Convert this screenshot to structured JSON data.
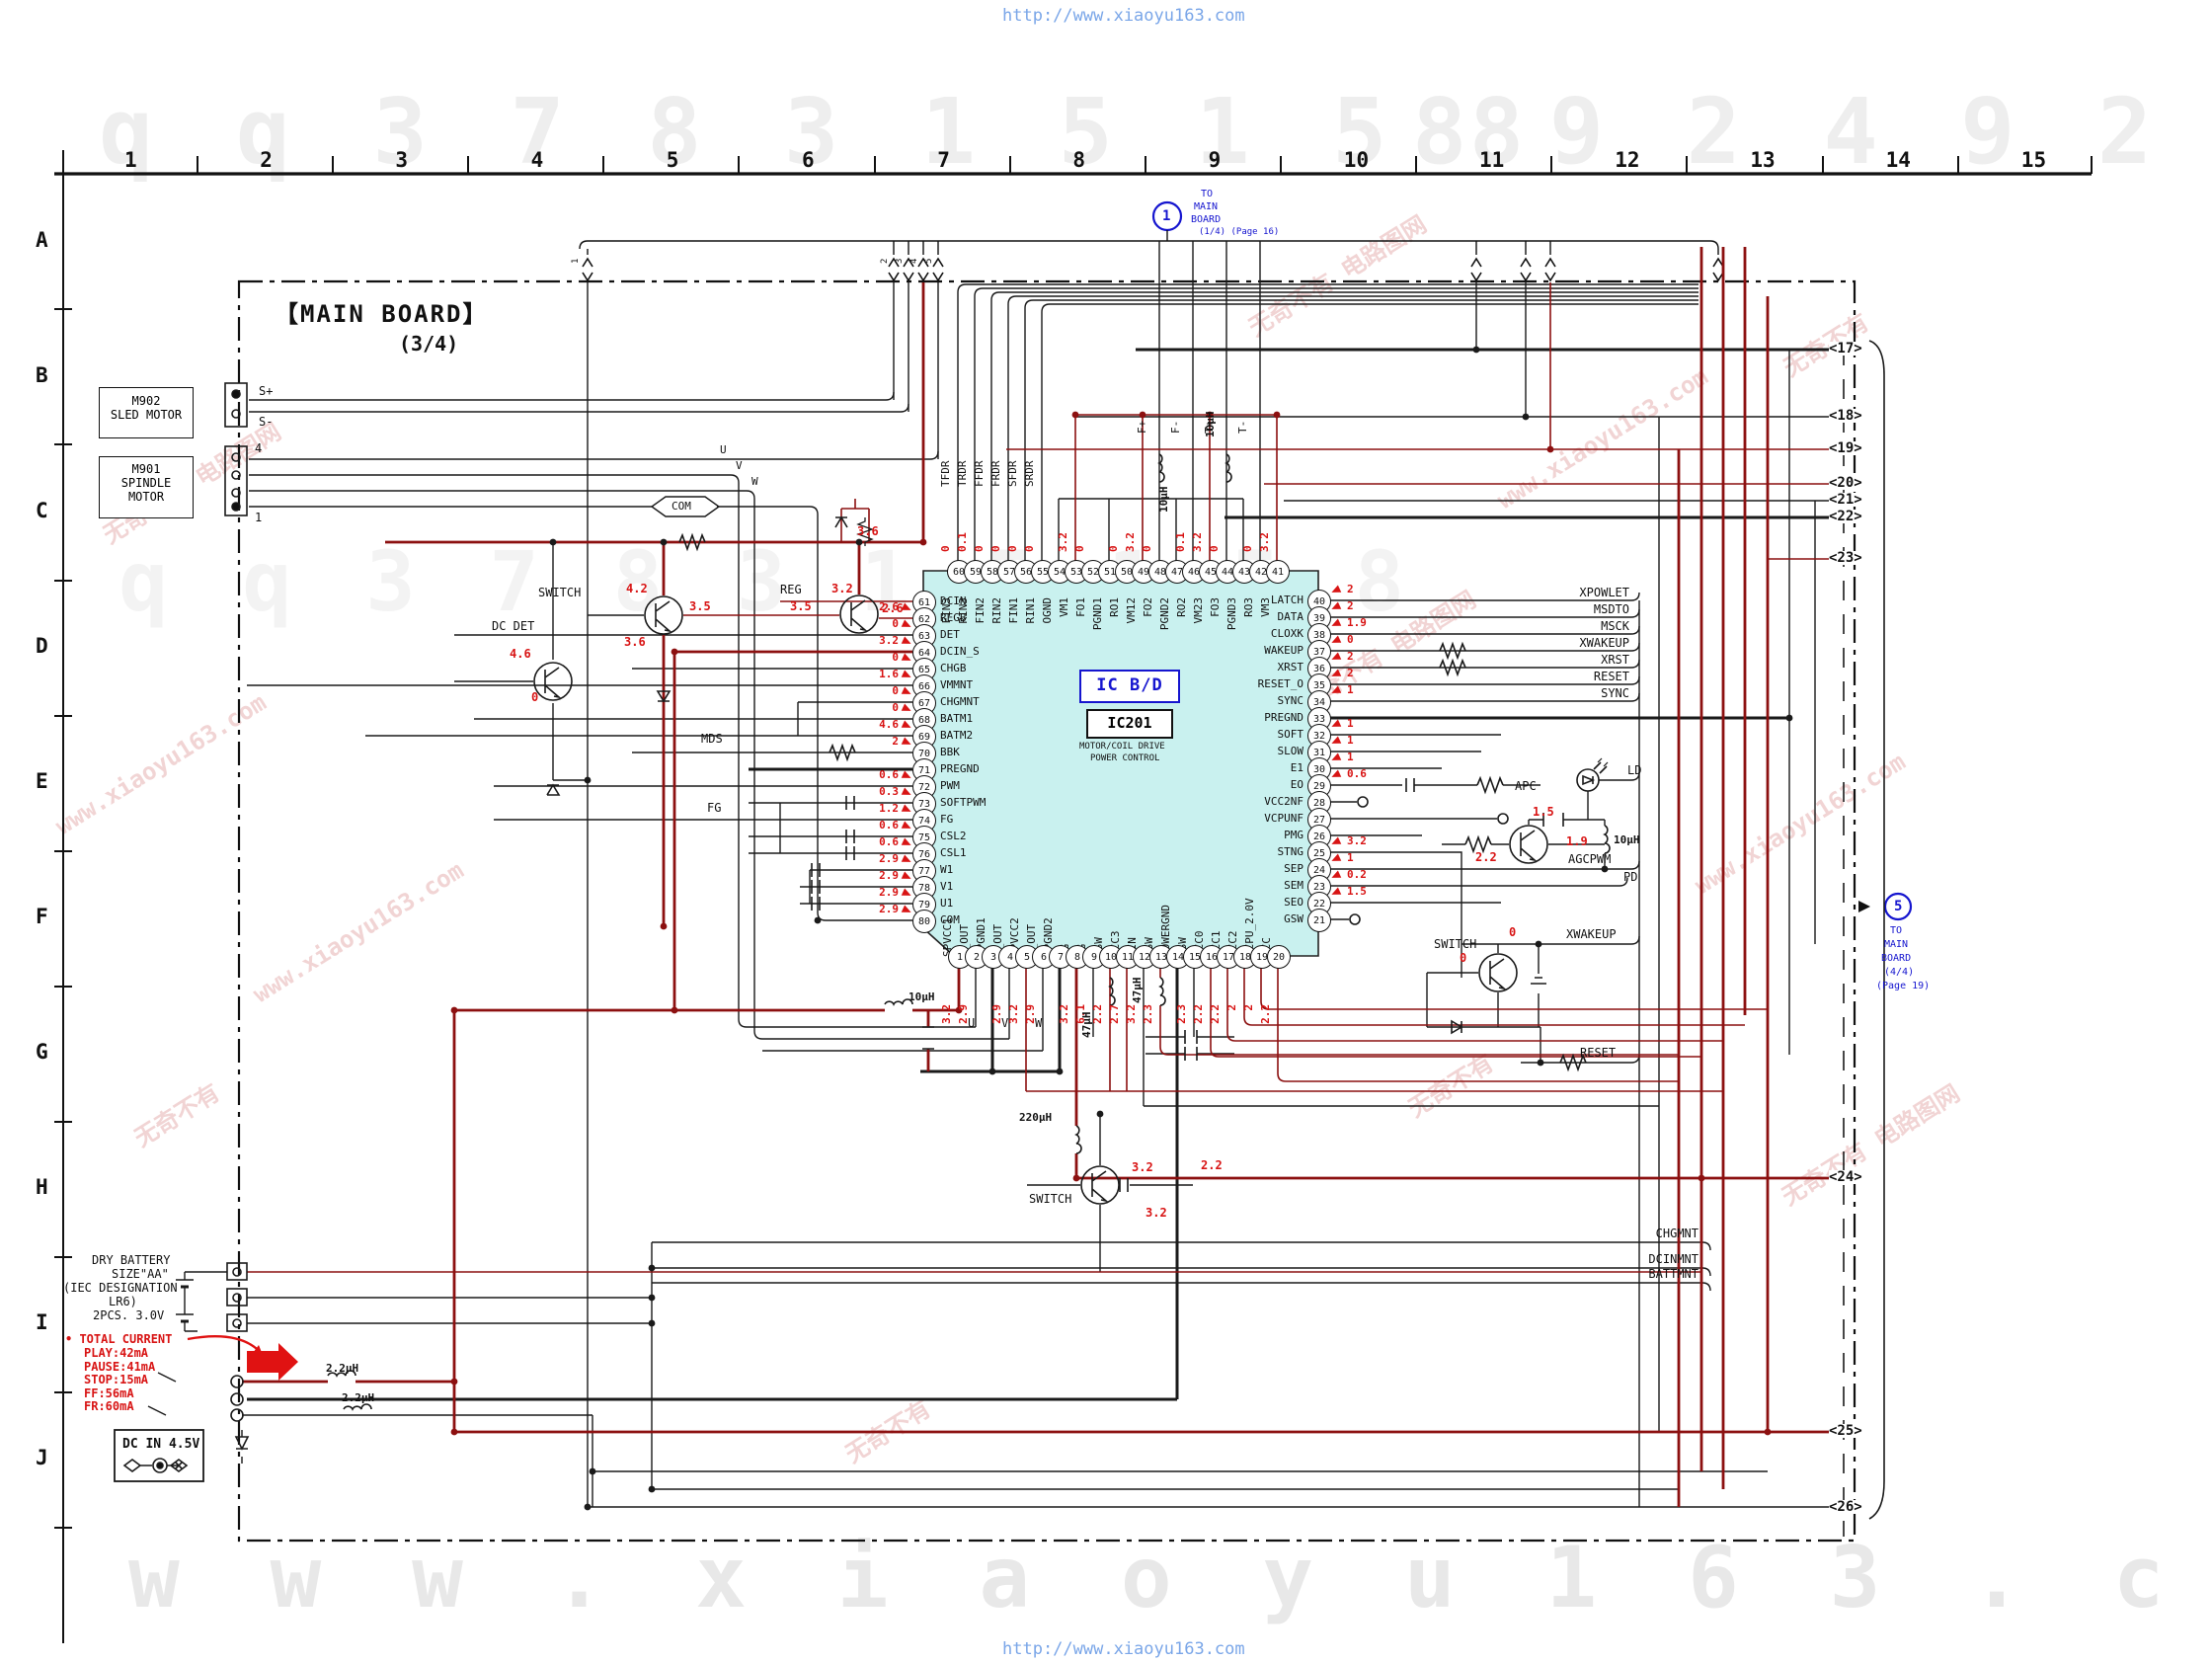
{
  "watermark": {
    "site_top": "http://www.xiaoyu163.com",
    "site_bottom": "http://www.xiaoyu163.com",
    "tiles": [
      "无奇不有  电路图网",
      "www.xiaoyu163.com",
      "无奇不有"
    ],
    "digits_left": "q q 3 7 8 3 1 5 1 5 8",
    "digits_right": "8 9 2 4 9 2 9 9",
    "big_bottom": "w w w . x i a o y u 1 6 3 . c o m"
  },
  "grid": {
    "columns": [
      "1",
      "2",
      "3",
      "4",
      "5",
      "6",
      "7",
      "8",
      "9",
      "10",
      "11",
      "12",
      "13",
      "14",
      "15"
    ],
    "rows": [
      "A",
      "B",
      "C",
      "D",
      "E",
      "F",
      "G",
      "H",
      "I",
      "J"
    ]
  },
  "board": {
    "title": "【MAIN BOARD】",
    "subtitle": "(3/4)"
  },
  "ref1": {
    "num": "1",
    "l1": "TO",
    "l2": "MAIN",
    "l3": "BOARD",
    "l4": "(1/4) (Page 16)"
  },
  "ref5": {
    "num": "5",
    "l1": "TO",
    "l2": "MAIN",
    "l3": "BOARD",
    "l4": "(4/4)",
    "l5": "(Page 19)"
  },
  "top_taps": [
    "1",
    "2",
    "3",
    "4",
    "5"
  ],
  "motors": {
    "sled": {
      "ref": "M902",
      "name": "SLED MOTOR",
      "pin_a": "S+",
      "pin_b": "S-"
    },
    "spindle": {
      "ref": "M901",
      "name1": "SPINDLE",
      "name2": "MOTOR",
      "pin_top": "4",
      "pin_bottom": "1"
    }
  },
  "ic": {
    "type_label": "IC B/D",
    "ref": "IC201",
    "desc1": "MOTOR/COIL DRIVE",
    "desc2": "POWER CONTROL",
    "left_pins": [
      {
        "n": "61",
        "name": "DCIN",
        "v": ""
      },
      {
        "n": "62",
        "name": "REGB",
        "v": "2.6"
      },
      {
        "n": "63",
        "name": "DET",
        "v": "0"
      },
      {
        "n": "64",
        "name": "DCIN_S",
        "v": "3.2"
      },
      {
        "n": "65",
        "name": "CHGB",
        "v": "0"
      },
      {
        "n": "66",
        "name": "VMMNT",
        "v": "1.6"
      },
      {
        "n": "67",
        "name": "CHGMNT",
        "v": "0"
      },
      {
        "n": "68",
        "name": "BATM1",
        "v": "0"
      },
      {
        "n": "69",
        "name": "BATM2",
        "v": "4.6"
      },
      {
        "n": "70",
        "name": "BBK",
        "v": "2"
      },
      {
        "n": "71",
        "name": "PREGND",
        "v": ""
      },
      {
        "n": "72",
        "name": "PWM",
        "v": "0.6"
      },
      {
        "n": "73",
        "name": "SOFTPWM",
        "v": "0.3"
      },
      {
        "n": "74",
        "name": "FG",
        "v": "1.2"
      },
      {
        "n": "75",
        "name": "CSL2",
        "v": "0.6"
      },
      {
        "n": "76",
        "name": "CSL1",
        "v": "0.6"
      },
      {
        "n": "77",
        "name": "W1",
        "v": "2.9"
      },
      {
        "n": "78",
        "name": "V1",
        "v": "2.9"
      },
      {
        "n": "79",
        "name": "U1",
        "v": "2.9"
      },
      {
        "n": "80",
        "name": "COM",
        "v": "2.9"
      }
    ],
    "top_pins": [
      {
        "n": "60",
        "name": "FIN3",
        "v": "0"
      },
      {
        "n": "59",
        "name": "RIN3",
        "v": "0.1"
      },
      {
        "n": "58",
        "name": "FIN2",
        "v": "0"
      },
      {
        "n": "57",
        "name": "RIN2",
        "v": "0"
      },
      {
        "n": "56",
        "name": "FIN1",
        "v": "0"
      },
      {
        "n": "55",
        "name": "RIN1",
        "v": "0"
      },
      {
        "n": "54",
        "name": "OGND",
        "v": ""
      },
      {
        "n": "53",
        "name": "VM1",
        "v": "3.2"
      },
      {
        "n": "52",
        "name": "FO1",
        "v": "0"
      },
      {
        "n": "51",
        "name": "PGND1",
        "v": ""
      },
      {
        "n": "50",
        "name": "RO1",
        "v": "0"
      },
      {
        "n": "49",
        "name": "VM12",
        "v": "3.2"
      },
      {
        "n": "48",
        "name": "FO2",
        "v": "0"
      },
      {
        "n": "47",
        "name": "PGND2",
        "v": ""
      },
      {
        "n": "46",
        "name": "RO2",
        "v": "0.1"
      },
      {
        "n": "45",
        "name": "VM23",
        "v": "3.2"
      },
      {
        "n": "44",
        "name": "FO3",
        "v": "0"
      },
      {
        "n": "43",
        "name": "PGND3",
        "v": ""
      },
      {
        "n": "42",
        "name": "RO3",
        "v": "0"
      },
      {
        "n": "41",
        "name": "VM3",
        "v": "3.2"
      }
    ],
    "right_pins": [
      {
        "n": "40",
        "name": "LATCH",
        "v": "2"
      },
      {
        "n": "39",
        "name": "DATA",
        "v": "2"
      },
      {
        "n": "38",
        "name": "CLOXK",
        "v": "1.9"
      },
      {
        "n": "37",
        "name": "WAKEUP",
        "v": "0"
      },
      {
        "n": "36",
        "name": "XRST",
        "v": "2"
      },
      {
        "n": "35",
        "name": "RESET_O",
        "v": "2"
      },
      {
        "n": "34",
        "name": "SYNC",
        "v": "1"
      },
      {
        "n": "33",
        "name": "PREGND",
        "v": ""
      },
      {
        "n": "32",
        "name": "SOFT",
        "v": "1"
      },
      {
        "n": "31",
        "name": "SLOW",
        "v": "1"
      },
      {
        "n": "30",
        "name": "E1",
        "v": "1"
      },
      {
        "n": "29",
        "name": "EO",
        "v": "0.6"
      },
      {
        "n": "28",
        "name": "VCC2NF",
        "v": ""
      },
      {
        "n": "27",
        "name": "VCPUNF",
        "v": ""
      },
      {
        "n": "26",
        "name": "PMG",
        "v": ""
      },
      {
        "n": "25",
        "name": "STNG",
        "v": "3.2"
      },
      {
        "n": "24",
        "name": "SEP",
        "v": "1"
      },
      {
        "n": "23",
        "name": "SEM",
        "v": "0.2"
      },
      {
        "n": "22",
        "name": "SEO",
        "v": "1.5"
      },
      {
        "n": "21",
        "name": "GSW",
        "v": ""
      }
    ],
    "bottom_pins": [
      {
        "n": "1",
        "name": "SPVCC1",
        "v": "3.2"
      },
      {
        "n": "2",
        "name": "U_OUT",
        "v": "2.9"
      },
      {
        "n": "3",
        "name": "SPGND1",
        "v": ""
      },
      {
        "n": "4",
        "name": "V_OUT",
        "v": "2.9"
      },
      {
        "n": "5",
        "name": "SPVCC2",
        "v": "3.2"
      },
      {
        "n": "6",
        "name": "W_OUT",
        "v": "2.9"
      },
      {
        "n": "7",
        "name": "SPGND2",
        "v": ""
      },
      {
        "n": "8",
        "name": "LG",
        "v": "3.2"
      },
      {
        "n": "9",
        "name": "VG",
        "v": "6.1"
      },
      {
        "n": "10",
        "name": "SSW",
        "v": "2.2"
      },
      {
        "n": "11",
        "name": "VCC3",
        "v": "2.7"
      },
      {
        "n": "12",
        "name": "VIN",
        "v": "3.2"
      },
      {
        "n": "13",
        "name": "DSW",
        "v": "2.3"
      },
      {
        "n": "14",
        "name": "POWERGND",
        "v": ""
      },
      {
        "n": "15",
        "name": "USW",
        "v": "2.3"
      },
      {
        "n": "16",
        "name": "VCC0",
        "v": "2.2"
      },
      {
        "n": "17",
        "name": "VCC1",
        "v": "2.2"
      },
      {
        "n": "18",
        "name": "VCC2",
        "v": "2"
      },
      {
        "n": "19",
        "name": "VCPU_2.0V",
        "v": "2"
      },
      {
        "n": "20",
        "name": "VCC",
        "v": "2.2"
      }
    ],
    "top_wire_labels": [
      "TFDR",
      "TRDR",
      "FFDR",
      "FRDR",
      "SFDR",
      "SRDR"
    ],
    "coil_wire_labels": [
      "F+",
      "F-",
      "T+",
      "T-"
    ],
    "bottom_wire_labels": [
      "U",
      "V",
      "W"
    ]
  },
  "right_signals": [
    "XPOWLET",
    "MSDTO",
    "MSCK",
    "XWAKEUP",
    "XRST",
    "RESET",
    "SYNC"
  ],
  "right_connectors": [
    "17",
    "18",
    "19",
    "20",
    "21",
    "22",
    "23",
    "24",
    "25",
    "26"
  ],
  "monitor_signals": [
    "CHGMNT",
    "DCINMNT",
    "BATTMNT"
  ],
  "annotations": {
    "dc_det": "DC DET",
    "switch_left": "SWITCH",
    "reg": "REG",
    "com": "COM",
    "u_left": "U",
    "v_left": "V",
    "w_left": "W",
    "mds": "MDS",
    "fg": "FG",
    "v_dcdet_a": "4.6",
    "v_dcdet_b": "0",
    "v_swl_a": "4.2",
    "v_swl_b": "3.5",
    "v_swl_c": "3.6",
    "v_reg_a": "3.2",
    "v_reg_b": "3.5",
    "v_reg_c": "2.6",
    "v_reg_d": "3.6",
    "l10a": "10µH",
    "l10b": "10µH",
    "l10c": "10µH",
    "l10d": "10µH",
    "l47a": "47µH",
    "l47b": "47µH",
    "l220": "220µH",
    "l22a": "2.2µH",
    "l22b": "2.2µH",
    "apc": "APC",
    "ld": "LD",
    "agcpwm": "AGCPWM",
    "pd": "PD",
    "switch_right": "SWITCH",
    "xwakeup_mid": "XWAKEUP",
    "reset_mid": "RESET",
    "v_apc_a": "1.5",
    "v_apc_b": "1.9",
    "v_apc_c": "2.2",
    "v_swr_a": "0",
    "v_swr_b": "0",
    "switch_bot": "SWITCH",
    "v_swb_a": "3.2",
    "v_swb_b": "3.2",
    "v_swb_c": "2.2"
  },
  "battery": {
    "l1": "DRY BATTERY",
    "l2": "SIZE\"AA\"",
    "l3": "(IEC DESIGNATION",
    "l4": "LR6)",
    "l5": "2PCS.  3.0V",
    "current_title": "TOTAL CURRENT",
    "current_lines": [
      "PLAY:42mA",
      "PAUSE:41mA",
      "STOP:15mA",
      "FF:56mA",
      "FR:60mA"
    ],
    "dc_in": "DC IN 4.5V"
  }
}
